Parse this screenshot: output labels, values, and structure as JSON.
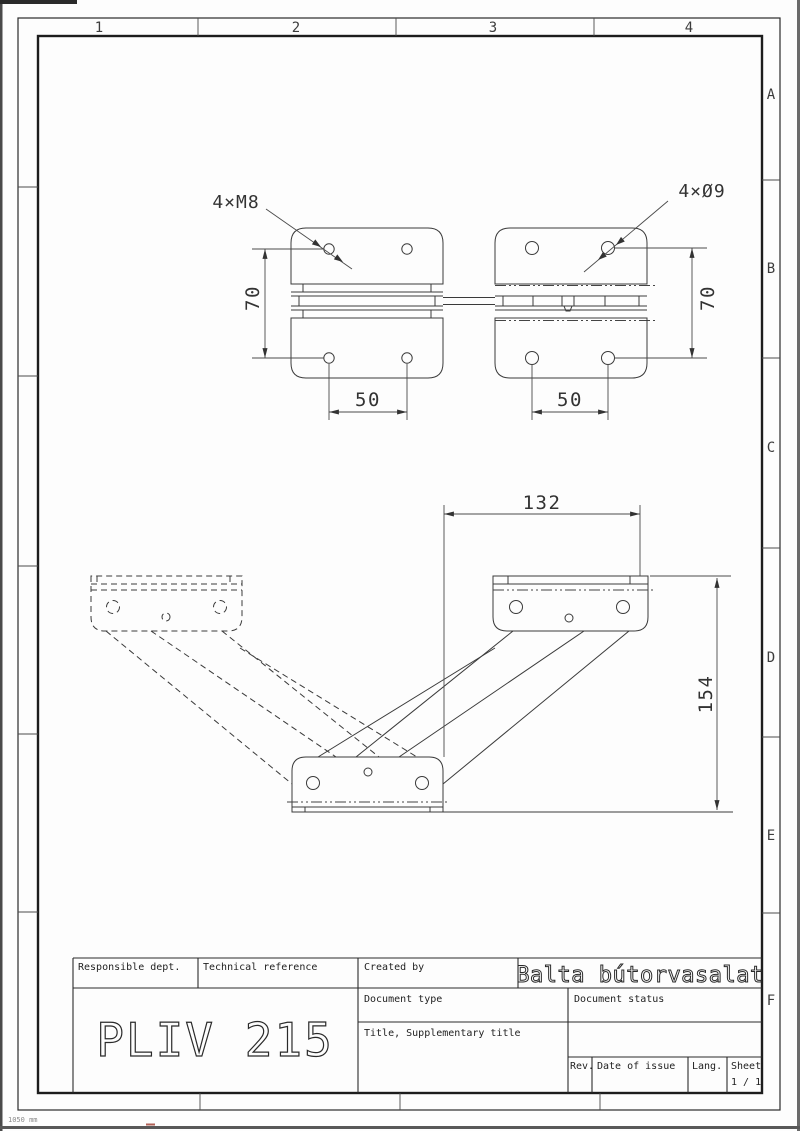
{
  "sheet": {
    "zones_top": [
      "1",
      "2",
      "3",
      "4"
    ],
    "zones_side": [
      "A",
      "B",
      "C",
      "D",
      "E",
      "F"
    ],
    "scan_note": "1050 mm"
  },
  "top_view": {
    "thread_callout": "4×M8",
    "hole_callout": "4×Ø9",
    "dim_left": "70",
    "dim_right": "70",
    "dim_spacing_left": "50",
    "dim_spacing_right": "50"
  },
  "front_view": {
    "dim_width": "132",
    "dim_height": "154"
  },
  "title_block": {
    "responsible_dept_label": "Responsible dept.",
    "technical_reference_label": "Technical reference",
    "created_by_label": "Created by",
    "company": "Balta bútorvasalat",
    "document_type_label": "Document type",
    "document_status_label": "Document status",
    "title_label": "Title, Supplementary title",
    "part_number": "PLIV 215",
    "rev_label": "Rev.",
    "date_of_issue_label": "Date of issue",
    "lang_label": "Lang.",
    "sheet_label": "Sheet",
    "sheet_value": "1 / 1"
  }
}
